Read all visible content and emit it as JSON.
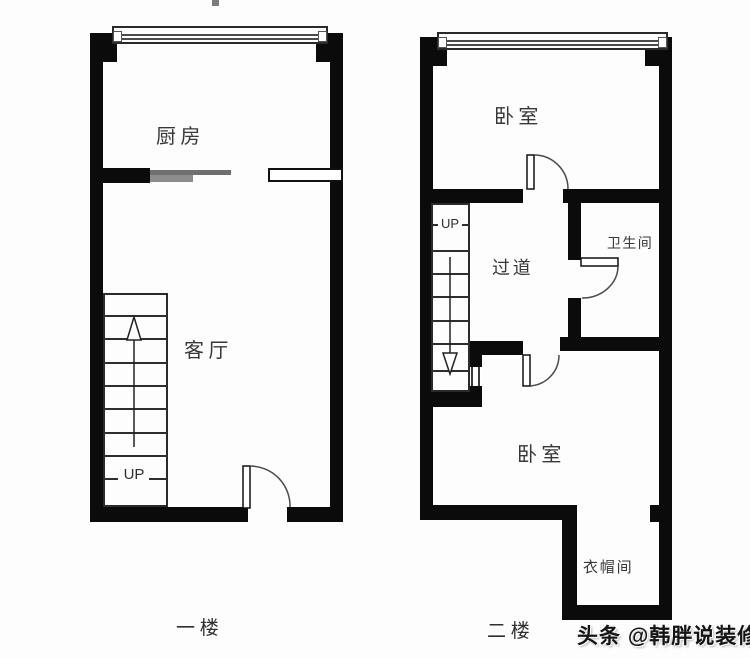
{
  "floor1": {
    "label": "一楼",
    "kitchen_label": "厨房",
    "living_label": "客厅",
    "stairs_up_label": "UP"
  },
  "floor2": {
    "label": "二楼",
    "bedroom_top_label": "卧室",
    "bathroom_label": "卫生间",
    "corridor_label": "过道",
    "stairs_up_label": "UP",
    "bedroom_bottom_label": "卧室",
    "cloakroom_label": "衣帽间"
  },
  "watermark": "头条 @韩胖说装修",
  "colors": {
    "wall": "#0b0b0b",
    "thin_line": "#2e2e2e",
    "door_arc": "#4a4a4a",
    "sliding_door_dark": "#6f6f6f",
    "sliding_door_light": "#8c8c8c",
    "label_text": "#383838",
    "watermark_text": "#141414",
    "background": "#fdfdfd"
  }
}
